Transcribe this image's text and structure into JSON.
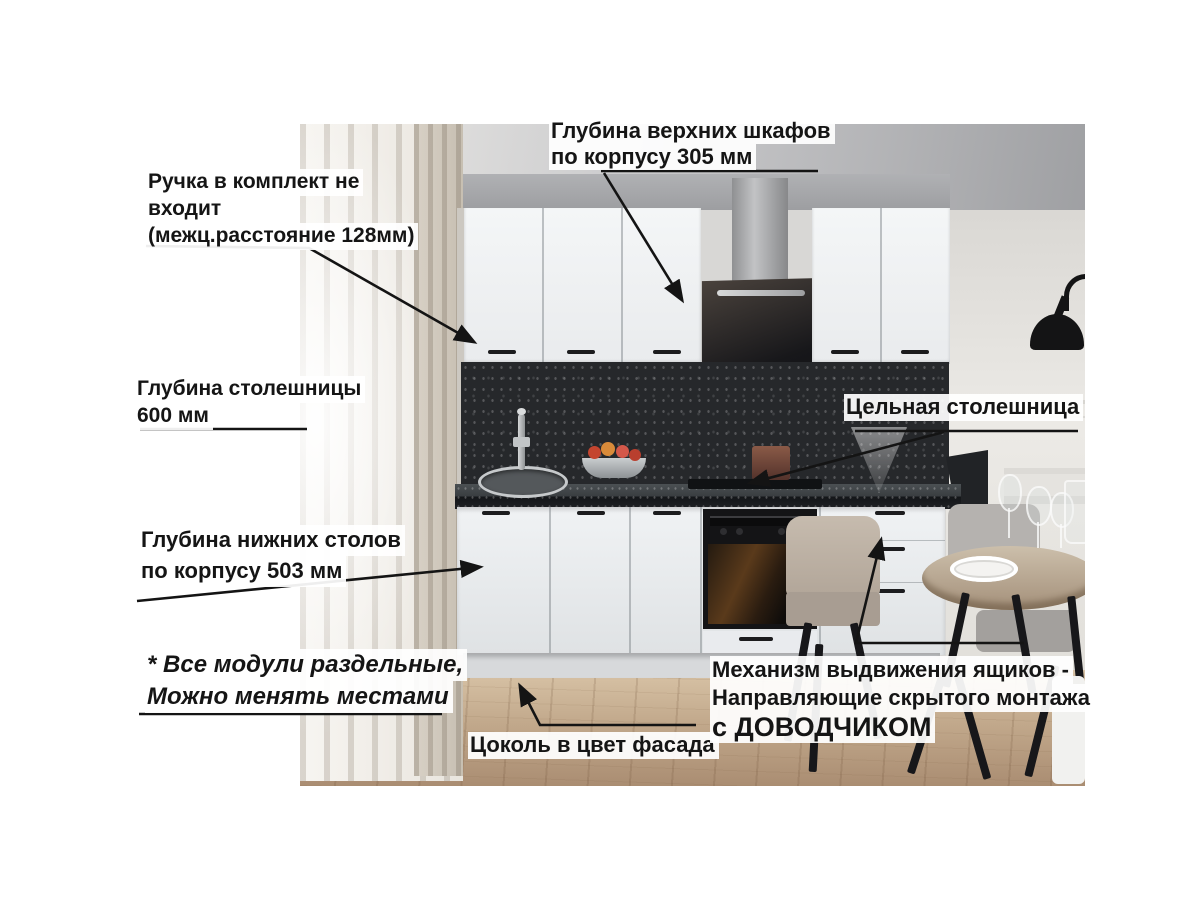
{
  "annotations": {
    "upper_depth": {
      "lines": [
        "Глубина верхних шкафов",
        "по корпусу 305 мм"
      ]
    },
    "handle_note": {
      "lines": [
        "Ручка в комплект не",
        "входит",
        "(межц.расстояние 128мм)"
      ]
    },
    "countertop_depth": {
      "lines": [
        "Глубина столешницы",
        "600 мм"
      ]
    },
    "solid_countertop": {
      "lines": [
        "Цельная столешница"
      ]
    },
    "base_depth": {
      "lines": [
        "Глубина нижних столов",
        "по корпусу 503 мм"
      ]
    },
    "modules_note": {
      "lines": [
        "* Все модули раздельные,",
        "Можно менять местами"
      ]
    },
    "plinth_note": {
      "lines": [
        "Цоколь в цвет фасада"
      ]
    },
    "drawer_mech": {
      "lines": [
        "Механизм выдвижения ящиков -",
        "Направляющие скрытого монтажа"
      ],
      "emphasis": "с ДОВОДЧИКОМ"
    }
  },
  "palette": {
    "label_text": "#151515",
    "label_bg": "#ffffff",
    "arrow": "#141414",
    "cabinet_white": "#f0f2f4",
    "backsplash_dark": "#26282b",
    "countertop_dark": "#1c1e20",
    "hood_black": "#17171a",
    "steel": "#b0b1b3",
    "floor_wood": "#c2a98c"
  }
}
